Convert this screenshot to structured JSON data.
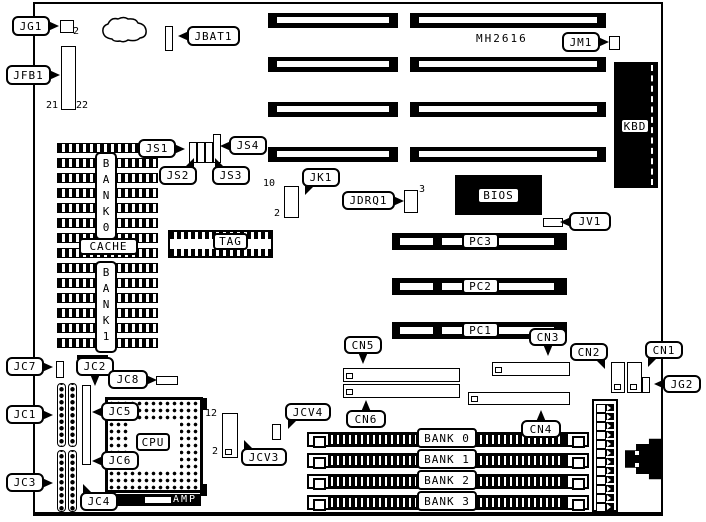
{
  "diagram": {
    "part_number": {
      "text": "MH2616",
      "x": 476,
      "y": 33
    },
    "callouts": [
      {
        "name": "jg1",
        "text": "JG1",
        "x": 12,
        "y": 16,
        "w": 38,
        "h": 20,
        "ptr": "right"
      },
      {
        "name": "jfb1",
        "text": "JFB1",
        "x": 6,
        "y": 65,
        "w": 45,
        "h": 20,
        "ptr": "right"
      },
      {
        "name": "jbat1",
        "text": "JBAT1",
        "x": 187,
        "y": 26,
        "w": 53,
        "h": 20,
        "ptr": "left"
      },
      {
        "name": "jm1",
        "text": "JM1",
        "x": 562,
        "y": 32,
        "w": 38,
        "h": 20,
        "ptr": "right"
      },
      {
        "name": "js1",
        "text": "JS1",
        "x": 138,
        "y": 139,
        "w": 38,
        "h": 19,
        "ptr": "right"
      },
      {
        "name": "js4",
        "text": "JS4",
        "x": 229,
        "y": 136,
        "w": 38,
        "h": 19,
        "ptr": "left"
      },
      {
        "name": "js2",
        "text": "JS2",
        "x": 159,
        "y": 166,
        "w": 38,
        "h": 19,
        "ptr": "up-right"
      },
      {
        "name": "js3",
        "text": "JS3",
        "x": 212,
        "y": 166,
        "w": 38,
        "h": 19,
        "ptr": "up-left"
      },
      {
        "name": "jk1",
        "text": "JK1",
        "x": 302,
        "y": 168,
        "w": 38,
        "h": 19,
        "ptr": "down-left"
      },
      {
        "name": "jdrq1",
        "text": "JDRQ1",
        "x": 342,
        "y": 191,
        "w": 53,
        "h": 19,
        "ptr": "right"
      },
      {
        "name": "jv1",
        "text": "JV1",
        "x": 569,
        "y": 212,
        "w": 42,
        "h": 19,
        "ptr": "left"
      },
      {
        "name": "cn5",
        "text": "CN5",
        "x": 344,
        "y": 336,
        "w": 38,
        "h": 18,
        "ptr": "down"
      },
      {
        "name": "cn3",
        "text": "CN3",
        "x": 529,
        "y": 328,
        "w": 38,
        "h": 18,
        "ptr": "down"
      },
      {
        "name": "cn2",
        "text": "CN2",
        "x": 570,
        "y": 343,
        "w": 38,
        "h": 18,
        "ptr": "down-right"
      },
      {
        "name": "cn1",
        "text": "CN1",
        "x": 645,
        "y": 341,
        "w": 38,
        "h": 18,
        "ptr": "down-left"
      },
      {
        "name": "jg2",
        "text": "JG2",
        "x": 663,
        "y": 375,
        "w": 38,
        "h": 18,
        "ptr": "left"
      },
      {
        "name": "cn6",
        "text": "CN6",
        "x": 346,
        "y": 410,
        "w": 40,
        "h": 18,
        "ptr": "up"
      },
      {
        "name": "cn4",
        "text": "CN4",
        "x": 521,
        "y": 420,
        "w": 40,
        "h": 18,
        "ptr": "up"
      },
      {
        "name": "jcv4",
        "text": "JCV4",
        "x": 285,
        "y": 403,
        "w": 46,
        "h": 18,
        "ptr": "down-left"
      },
      {
        "name": "jcv3",
        "text": "JCV3",
        "x": 241,
        "y": 448,
        "w": 46,
        "h": 18,
        "ptr": "up-left"
      },
      {
        "name": "jc7",
        "text": "JC7",
        "x": 6,
        "y": 357,
        "w": 38,
        "h": 19,
        "ptr": "right"
      },
      {
        "name": "jc2",
        "text": "JC2",
        "x": 76,
        "y": 357,
        "w": 38,
        "h": 19,
        "ptr": "down"
      },
      {
        "name": "jc8",
        "text": "JC8",
        "x": 108,
        "y": 370,
        "w": 40,
        "h": 19,
        "ptr": "right"
      },
      {
        "name": "jc1",
        "text": "JC1",
        "x": 6,
        "y": 405,
        "w": 38,
        "h": 19,
        "ptr": "right"
      },
      {
        "name": "jc5",
        "text": "JC5",
        "x": 101,
        "y": 402,
        "w": 38,
        "h": 19,
        "ptr": "left"
      },
      {
        "name": "jc6",
        "text": "JC6",
        "x": 101,
        "y": 451,
        "w": 38,
        "h": 19,
        "ptr": "left"
      },
      {
        "name": "jc3",
        "text": "JC3",
        "x": 6,
        "y": 473,
        "w": 38,
        "h": 19,
        "ptr": "right"
      },
      {
        "name": "jc4",
        "text": "JC4",
        "x": 80,
        "y": 492,
        "w": 38,
        "h": 19,
        "ptr": "up-left"
      }
    ],
    "part_labels": [
      {
        "name": "cpu-label",
        "text": "CPU",
        "x": 136,
        "y": 433,
        "w": 34,
        "h": 18
      },
      {
        "name": "tag-label",
        "text": "TAG",
        "x": 213,
        "y": 233,
        "w": 35,
        "h": 17
      },
      {
        "name": "cache-label",
        "text": "CACHE",
        "x": 79,
        "y": 238,
        "w": 59,
        "h": 17
      },
      {
        "name": "bios-label",
        "text": "BIOS",
        "x": 477,
        "y": 187,
        "w": 43,
        "h": 17
      },
      {
        "name": "kbd-label",
        "text": "KBD",
        "x": 620,
        "y": 118,
        "w": 30,
        "h": 16
      },
      {
        "name": "pc3-label",
        "text": "PC3",
        "x": 462,
        "y": 233,
        "w": 37,
        "h": 16
      },
      {
        "name": "pc2-label",
        "text": "PC2",
        "x": 462,
        "y": 278,
        "w": 37,
        "h": 16
      },
      {
        "name": "pc1-label",
        "text": "PC1",
        "x": 462,
        "y": 322,
        "w": 37,
        "h": 16
      },
      {
        "name": "bank0-label",
        "text": "BANK 0",
        "x": 417,
        "y": 428,
        "w": 60,
        "h": 20
      },
      {
        "name": "bank1-label",
        "text": "BANK 1",
        "x": 417,
        "y": 449,
        "w": 60,
        "h": 20
      },
      {
        "name": "bank2-label",
        "text": "BANK 2",
        "x": 417,
        "y": 470,
        "w": 60,
        "h": 20
      },
      {
        "name": "bank3-label",
        "text": "BANK 3",
        "x": 417,
        "y": 491,
        "w": 60,
        "h": 20
      }
    ],
    "vertical_labels": [
      {
        "name": "bank0-vertical-label",
        "text": "B\nA\nN\nK\n0",
        "x": 95,
        "y": 152,
        "w": 22,
        "h": 88
      },
      {
        "name": "bank1-vertical-label",
        "text": "B\nA\nN\nK\n1",
        "x": 95,
        "y": 261,
        "w": 22,
        "h": 92
      }
    ],
    "pin_numbers": [
      {
        "name": "jg1-pin-2",
        "text": "2",
        "x": 73,
        "y": 26
      },
      {
        "name": "jfb1-pin-21",
        "text": "21",
        "x": 46,
        "y": 100
      },
      {
        "name": "jfb1-pin-22",
        "text": "22",
        "x": 76,
        "y": 100
      },
      {
        "name": "jk1-pin-10",
        "text": "10",
        "x": 263,
        "y": 178
      },
      {
        "name": "jk1-pin-2",
        "text": "2",
        "x": 274,
        "y": 208
      },
      {
        "name": "jdrq1-pin-3",
        "text": "3",
        "x": 419,
        "y": 184
      },
      {
        "name": "jcv3-pin-12",
        "text": "12",
        "x": 205,
        "y": 408
      },
      {
        "name": "jcv3-pin-2",
        "text": "2",
        "x": 212,
        "y": 446
      }
    ],
    "amp_bar_label": "AMP"
  },
  "components": {
    "board_outline": {
      "x": 33,
      "y": 2,
      "w": 630,
      "h": 514
    },
    "isa_slots": [
      {
        "name": "isa-slot-1",
        "x": 268,
        "y": 13,
        "w": 130,
        "h": 15
      },
      {
        "name": "isa-slot-2",
        "x": 268,
        "y": 57,
        "w": 130,
        "h": 15
      },
      {
        "name": "isa-slot-3",
        "x": 268,
        "y": 102,
        "w": 130,
        "h": 15
      },
      {
        "name": "isa-slot-4",
        "x": 268,
        "y": 147,
        "w": 130,
        "h": 15
      },
      {
        "name": "isa-slot-5",
        "x": 410,
        "y": 13,
        "w": 196,
        "h": 15
      },
      {
        "name": "isa-slot-6",
        "x": 410,
        "y": 57,
        "w": 196,
        "h": 15
      },
      {
        "name": "isa-slot-7",
        "x": 410,
        "y": 102,
        "w": 196,
        "h": 15
      },
      {
        "name": "isa-slot-8",
        "x": 410,
        "y": 147,
        "w": 196,
        "h": 15
      }
    ],
    "pci_slots": [
      {
        "name": "pci-slot-pc3",
        "x": 392,
        "y": 233,
        "w": 175,
        "h": 17
      },
      {
        "name": "pci-slot-pc2",
        "x": 392,
        "y": 278,
        "w": 175,
        "h": 17
      },
      {
        "name": "pci-slot-pc1",
        "x": 392,
        "y": 322,
        "w": 175,
        "h": 17
      }
    ],
    "simm_sockets": [
      {
        "name": "simm-socket-bank0",
        "x": 307,
        "y": 432,
        "w": 282,
        "h": 15
      },
      {
        "name": "simm-socket-bank1",
        "x": 307,
        "y": 453,
        "w": 282,
        "h": 15
      },
      {
        "name": "simm-socket-bank2",
        "x": 307,
        "y": 474,
        "w": 282,
        "h": 15
      },
      {
        "name": "simm-socket-bank3",
        "x": 307,
        "y": 495,
        "w": 282,
        "h": 15
      }
    ],
    "pin_headers": [
      {
        "name": "jg1-connector",
        "x": 60,
        "y": 20,
        "w": 14,
        "h": 13
      },
      {
        "name": "jfb1-header",
        "x": 61,
        "y": 46,
        "w": 15,
        "h": 64
      },
      {
        "name": "jbat1-connector",
        "x": 165,
        "y": 26,
        "w": 8,
        "h": 25
      },
      {
        "name": "jm1-connector",
        "x": 609,
        "y": 36,
        "w": 11,
        "h": 14
      },
      {
        "name": "js1-jumper",
        "x": 189,
        "y": 142,
        "w": 8,
        "h": 21
      },
      {
        "name": "js2-jumper",
        "x": 197,
        "y": 142,
        "w": 8,
        "h": 21
      },
      {
        "name": "js3-jumper",
        "x": 205,
        "y": 142,
        "w": 8,
        "h": 21
      },
      {
        "name": "js4-jumper",
        "x": 213,
        "y": 134,
        "w": 8,
        "h": 29
      },
      {
        "name": "jk1-header",
        "x": 284,
        "y": 186,
        "w": 15,
        "h": 32
      },
      {
        "name": "jdrq1-header",
        "x": 404,
        "y": 190,
        "w": 14,
        "h": 23
      },
      {
        "name": "jv1-connector",
        "x": 543,
        "y": 218,
        "w": 20,
        "h": 9
      },
      {
        "name": "cn5-header",
        "x": 343,
        "y": 368,
        "w": 117,
        "h": 14,
        "pin1": true
      },
      {
        "name": "cn6-header",
        "x": 343,
        "y": 384,
        "w": 117,
        "h": 14,
        "pin1": true
      },
      {
        "name": "cn3-header",
        "x": 492,
        "y": 362,
        "w": 78,
        "h": 14,
        "pin1": true
      },
      {
        "name": "cn4-header",
        "x": 468,
        "y": 392,
        "w": 102,
        "h": 13,
        "pin1": true
      },
      {
        "name": "cn2-header",
        "x": 611,
        "y": 362,
        "w": 14,
        "h": 31,
        "pin1": true
      },
      {
        "name": "cn1-header",
        "x": 627,
        "y": 362,
        "w": 15,
        "h": 31,
        "pin1": true
      },
      {
        "name": "jg2-connector",
        "x": 642,
        "y": 377,
        "w": 8,
        "h": 16
      },
      {
        "name": "jc7-connector",
        "x": 56,
        "y": 361,
        "w": 8,
        "h": 17
      },
      {
        "name": "jc8-connector",
        "x": 156,
        "y": 376,
        "w": 22,
        "h": 9
      },
      {
        "name": "jcv3-header",
        "x": 222,
        "y": 413,
        "w": 16,
        "h": 45,
        "pin1": true
      },
      {
        "name": "jcv4-jumper",
        "x": 272,
        "y": 424,
        "w": 9,
        "h": 16
      },
      {
        "name": "jc5-jc6-header",
        "x": 82,
        "y": 385,
        "w": 9,
        "h": 80
      }
    ],
    "dot_headers": [
      {
        "name": "jc2-header-col1",
        "x": 57,
        "y": 383,
        "w": 9,
        "h": 64
      },
      {
        "name": "jc2-header-col2",
        "x": 68,
        "y": 383,
        "w": 9,
        "h": 64
      },
      {
        "name": "jc3-jc4-header-col1",
        "x": 57,
        "y": 450,
        "w": 9,
        "h": 62
      },
      {
        "name": "jc3-jc4-header-col2",
        "x": 68,
        "y": 450,
        "w": 9,
        "h": 62
      }
    ],
    "black_chips": [
      {
        "name": "bios-chip",
        "x": 455,
        "y": 175,
        "w": 87,
        "h": 40
      },
      {
        "name": "kbd-connector",
        "x": 614,
        "y": 62,
        "w": 44,
        "h": 126,
        "dashed": true
      },
      {
        "name": "crystal-bar",
        "x": 77,
        "y": 355,
        "w": 31,
        "h": 4
      }
    ],
    "cache_block": {
      "name": "cache-chip-block",
      "x": 57,
      "y": 143,
      "w": 99,
      "h": 205,
      "rows": 14
    },
    "tag_chip": {
      "name": "tag-chip",
      "x": 168,
      "y": 230,
      "w": 105,
      "h": 28
    },
    "cpu_socket": {
      "name": "cpu-socket",
      "x": 105,
      "y": 397,
      "w": 98,
      "h": 96
    },
    "power_connector": {
      "name": "power-connector",
      "x": 592,
      "y": 399,
      "w": 26,
      "h": 113,
      "pins": 12
    },
    "ext_connector": {
      "name": "external-port",
      "x": 625,
      "y": 437,
      "w": 38,
      "h": 44
    },
    "amp_bar": {
      "name": "amp-connector",
      "x": 113,
      "y": 494,
      "w": 88,
      "h": 12
    },
    "blob": {
      "name": "thermal-outline",
      "x": 100,
      "y": 14,
      "w": 50,
      "h": 32
    }
  }
}
